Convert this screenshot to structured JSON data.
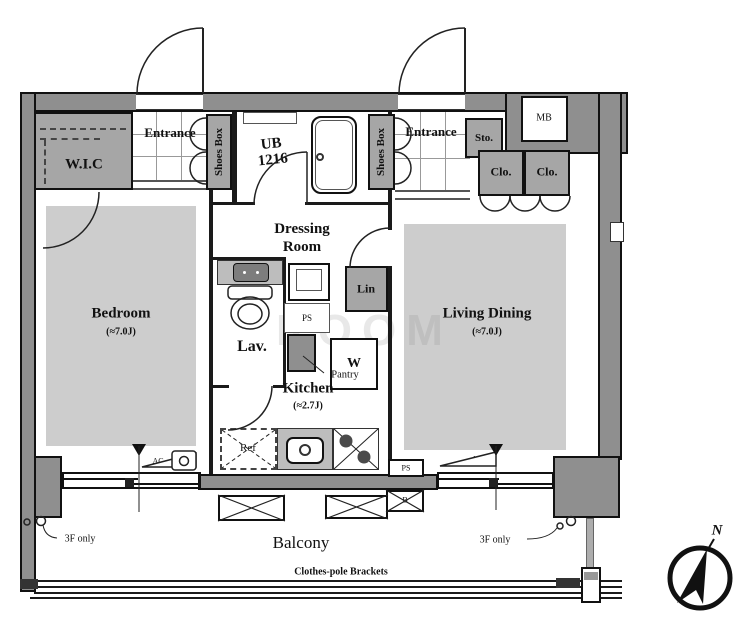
{
  "colors": {
    "wall": "#8f8f8f",
    "closet": "#a6a6a6",
    "carpet": "#cdcdcd",
    "counter": "#bdbdbd"
  },
  "rooms": {
    "wic": {
      "label": "W.I.C"
    },
    "entrance_left": {
      "label": "Entrance"
    },
    "entrance_right": {
      "label": "Entrance"
    },
    "unit_bath": {
      "label": "UB",
      "size": "1216"
    },
    "dressing_room": {
      "line1": "Dressing",
      "line2": "Room"
    },
    "lavatory": {
      "label": "Lav."
    },
    "kitchen": {
      "label": "Kitchen",
      "size": "(≈2.7J)"
    },
    "bedroom": {
      "label": "Bedroom",
      "size": "(≈7.0J)"
    },
    "living_dining": {
      "label": "Living Dining",
      "size": "(≈7.0J)"
    },
    "balcony": {
      "label": "Balcony"
    }
  },
  "storage": {
    "shoes_box_left": {
      "label": "Shoes Box"
    },
    "shoes_box_right": {
      "label": "Shoes Box"
    },
    "storage_box": {
      "label": "Sto."
    },
    "meter_box": {
      "label": "MB"
    },
    "closet_left": {
      "label": "Clo."
    },
    "closet_right": {
      "label": "Clo."
    },
    "linen": {
      "label": "Lin"
    },
    "pantry": {
      "label": "Pantry"
    }
  },
  "fixtures": {
    "refrigerator": {
      "label": "Ref"
    },
    "washer": {
      "label": "W"
    }
  },
  "equipment": {
    "pipe_space_mid": {
      "label": "PS"
    },
    "pipe_space_bottom": {
      "label": "PS"
    },
    "b_unit": {
      "label": "B"
    },
    "ac_left": {
      "label": "AC"
    },
    "ac_right": {
      "label": "AC"
    }
  },
  "annotations": {
    "clothes_pole": "Clothes-pole Brackets",
    "third_floor_left": "3F only",
    "third_floor_right": "3F only"
  },
  "compass": {
    "north": "N"
  },
  "watermark": {
    "text": "ROOM"
  }
}
